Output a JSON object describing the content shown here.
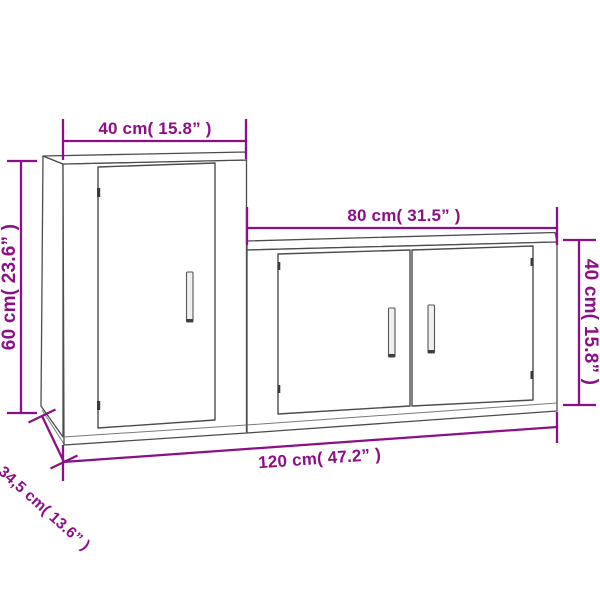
{
  "diagram": {
    "type": "furniture-dimension-diagram",
    "accent_color": "#8C0F88",
    "outline_color": "#4c4c4c",
    "background_color": "#ffffff",
    "dimensions": {
      "cabinet_width": "40 cm( 15.8” )",
      "cabinet_height": "60 cm( 23.6” )",
      "sideboard_width": "80 cm( 31.5” )",
      "sideboard_height": "40 cm( 15.8” )",
      "total_width": "120 cm( 47.2” )",
      "depth": "34,5 cm( 13.6” )"
    }
  }
}
